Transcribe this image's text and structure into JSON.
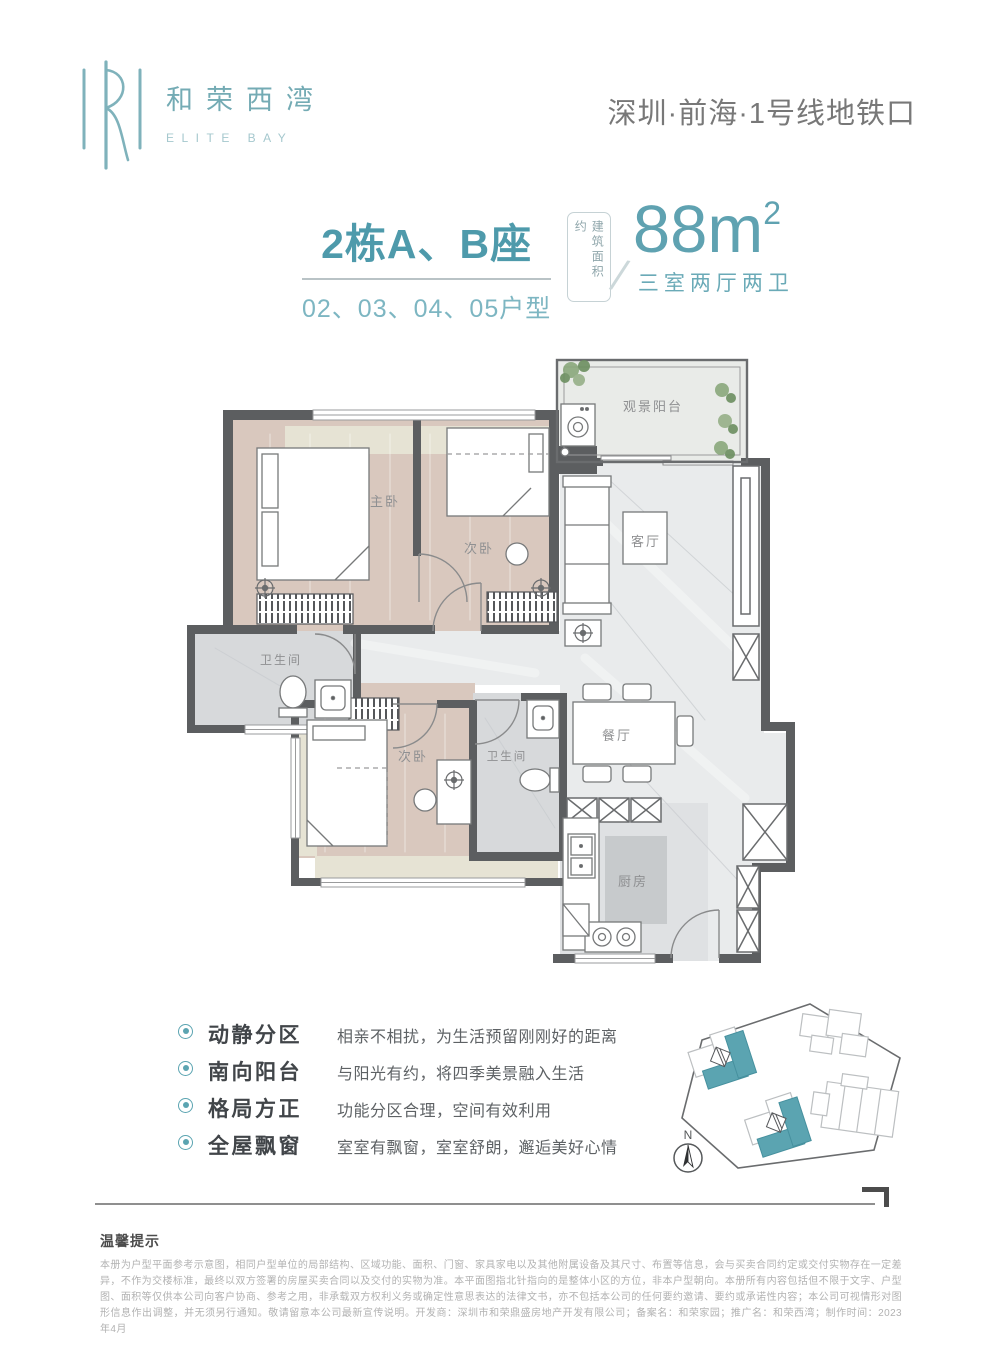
{
  "header": {
    "logo_cn": "和荣西湾",
    "logo_en": "ELITE BAY",
    "location": "深圳·前海·1号线地铁口"
  },
  "title_block": {
    "building": "2栋A、B座",
    "units": "02、03、04、05户型",
    "area_label": "建筑面积约",
    "area_value": "88m",
    "area_sup": "2",
    "layout": "三室两厅两卫"
  },
  "floorplan": {
    "rooms": {
      "balcony": "观景阳台",
      "master": "主卧",
      "bedroom2": "次卧",
      "living": "客厅",
      "bath_a": "卫生间",
      "bedroom3": "次卧",
      "bath_b": "卫生间",
      "dining": "餐厅",
      "kitchen": "厨房"
    }
  },
  "features": [
    {
      "title": "动静分区",
      "desc": "相亲不相扰，为生活预留刚刚好的距离"
    },
    {
      "title": "南向阳台",
      "desc": "与阳光有约，将四季美景融入生活"
    },
    {
      "title": "格局方正",
      "desc": "功能分区合理，空间有效利用"
    },
    {
      "title": "全屋飘窗",
      "desc": "室室有飘窗，室室舒朗，邂逅美好心情"
    }
  ],
  "siteplan": {
    "north_label": "N"
  },
  "disclaimer": {
    "title": "温馨提示",
    "body": "本册为户型平面参考示意图，相同户型单位的局部结构、区域功能、面积、门窗、家具家电以及其他附属设备及其尺寸、布置等信息，会与买卖合同约定或交付实物存在一定差异，不作为交楼标准，最终以双方签署的房屋买卖合同以及交付的实物为准。本平面图指北针指向的是整体小区的方位，非本户型朝向。本册所有内容包括但不限于文字、户型图、面积等仅供本公司向客户协商、参考之用，非承载双方权利义务或确定性意思表达的法律文书，亦不包括本公司的任何要约邀请、要约或承诺性内容；本公司可视情形对图形信息作出调整，并无须另行通知。敬请留意本公司最新宣传说明。开发商：深圳市和荣鼎盛房地产开发有限公司；备案名：和荣家园；推广名：和荣西湾；制作时间：2023年4月"
  },
  "colors": {
    "accent": "#58a0af",
    "accent_light": "#7db6c2",
    "wall": "#5c5e60",
    "wood": "#d9c8be",
    "marble": "#e9ebec",
    "beige": "#e6e3d4"
  }
}
